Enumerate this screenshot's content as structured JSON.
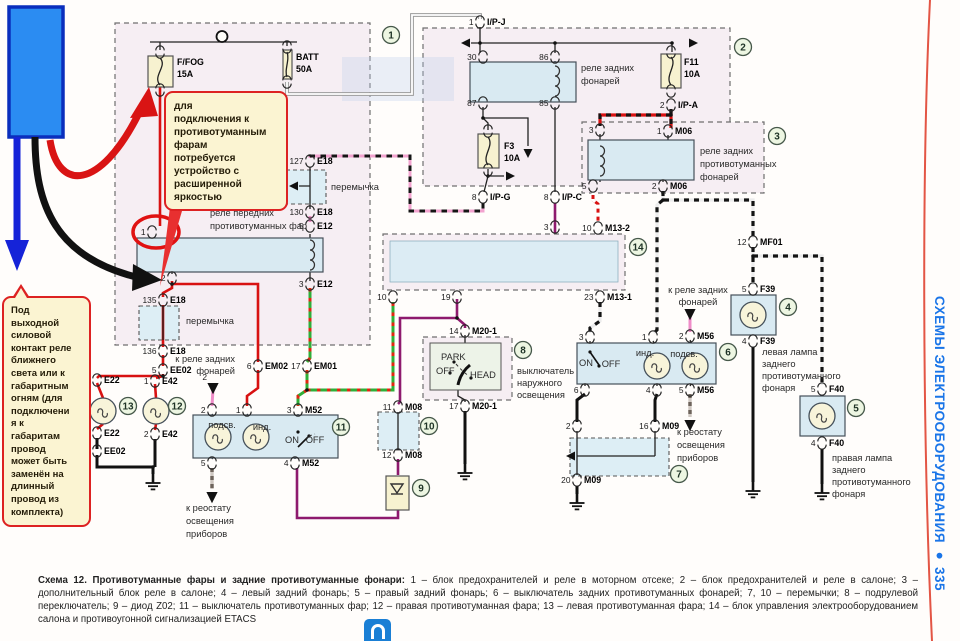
{
  "page": {
    "side_label": "СХЕМЫ ЭЛЕКТРООБОРУДОВАНИЯ ● 335",
    "caption_title": "Схема 12. Противотуманные фары и задние противотуманные фонари:",
    "caption_body": "1 – блок предохранителей и реле в моторном отсеке; 2 – блок предохранителей и реле в салоне; 3 – дополнительный блок реле в салоне; 4 – левый задний фонарь; 5 – правый задний фонарь; 6 – выключатель задних противотуманных фонарей; 7, 10 – перемычки; 8 – подрулевой переключатель; 9 – диод Z02; 11 – выключатель противотуманных фар; 12 – правая противотуманная фара; 13 – левая противотуманная фара; 14 – блок управления электрооборудованием салона и противоугонной сигнализацией ETACS",
    "colors": {
      "annotation_blue": "#2b8cf2",
      "annotation_red": "#d91414",
      "accent_blue_text": "#1a75e8",
      "callout_fill": "#fbf4d2"
    }
  },
  "callouts": {
    "top": "для\nподключения к\nпротивотуманным\nфарам\nпотребуется\nустройство с\nрасширенной\nяркостью",
    "left": "Под\nвыходной\nсиловой\nконтакт реле\nближнего\nсвета или к\nгабаритным\nогням (для\nподключени\nя к\nгабаритам\nпровод\nможет быть\nзаменён на\nдлинный\nпровод из\nкомплекта)"
  },
  "labels": {
    "ffog": "F/FOG",
    "ffog_a": "15A",
    "batt": "BATT",
    "batt_a": "50A",
    "f3": "F3",
    "f3_a": "10A",
    "f11": "F11",
    "f11_a": "10A",
    "relay_front_1": "реле передних",
    "relay_front_2": "противотуманных фар",
    "relay_rear_1": "реле задних",
    "relay_rear_2": "фонарей",
    "relay_rearfog_1": "реле задних",
    "relay_rearfog_2": "противотуманных",
    "relay_rearfog_3": "фонарей",
    "jumper": "перемычка",
    "ext_sw_1": "выключатель",
    "ext_sw_2": "наружного",
    "ext_sw_3": "освещения",
    "park": "PARK",
    "off": "OFF",
    "head": "HEAD",
    "on": "ON",
    "ind": "инд.",
    "podsv": "подсв.",
    "to_rear_1": "к реле задних",
    "to_rear_2": "фонарей",
    "rheo_1": "к реостату",
    "rheo_2": "освещения",
    "rheo_3": "приборов",
    "lamp_left_1": "левая лампа",
    "lamp_left_2": "заднего",
    "lamp_left_3": "противотуманного",
    "lamp_left_4": "фонаря",
    "lamp_right_1": "правая лампа",
    "lamp_right_2": "заднего",
    "lamp_right_3": "противотуманного",
    "lamp_right_4": "фонаря",
    "pin2": "2"
  },
  "schematic": {
    "connectors": [
      {
        "p": "1",
        "id": "I/P-J",
        "x": 480,
        "y": 22
      },
      {
        "p": "",
        "id": "",
        "x": 160,
        "y": 52
      },
      {
        "p": "",
        "id": "",
        "x": 160,
        "y": 90
      },
      {
        "p": "",
        "id": "",
        "x": 287,
        "y": 47
      },
      {
        "p": "",
        "id": "",
        "x": 287,
        "y": 82
      },
      {
        "p": "30",
        "id": "",
        "x": 483,
        "y": 57
      },
      {
        "p": "86",
        "id": "",
        "x": 555,
        "y": 57
      },
      {
        "p": "87",
        "id": "",
        "x": 483,
        "y": 103
      },
      {
        "p": "85",
        "id": "",
        "x": 555,
        "y": 103
      },
      {
        "p": "",
        "id": "",
        "x": 488,
        "y": 131
      },
      {
        "p": "",
        "id": "",
        "x": 488,
        "y": 170
      },
      {
        "p": "8",
        "id": "I/P-G",
        "x": 483,
        "y": 197
      },
      {
        "p": "8",
        "id": "I/P-C",
        "x": 555,
        "y": 197
      },
      {
        "p": "",
        "id": "",
        "x": 671,
        "y": 52
      },
      {
        "p": "",
        "id": "",
        "x": 671,
        "y": 91
      },
      {
        "p": "2",
        "id": "I/P-A",
        "x": 671,
        "y": 105
      },
      {
        "p": "1",
        "id": "M06",
        "x": 668,
        "y": 131
      },
      {
        "p": "3",
        "id": "",
        "x": 600,
        "y": 130
      },
      {
        "p": "5",
        "id": "",
        "x": 593,
        "y": 186
      },
      {
        "p": "2",
        "id": "M06",
        "x": 663,
        "y": 186
      },
      {
        "p": "127",
        "id": "E18",
        "x": 310,
        "y": 161
      },
      {
        "p": "130",
        "id": "E18",
        "x": 310,
        "y": 212
      },
      {
        "p": "5",
        "id": "E12",
        "x": 310,
        "y": 226
      },
      {
        "p": "3",
        "id": "E12",
        "x": 310,
        "y": 284
      },
      {
        "p": "1",
        "id": "",
        "x": 152,
        "y": 232
      },
      {
        "p": "2",
        "id": "",
        "x": 172,
        "y": 278
      },
      {
        "p": "135",
        "id": "E18",
        "x": 163,
        "y": 300
      },
      {
        "p": "136",
        "id": "E18",
        "x": 163,
        "y": 351
      },
      {
        "p": "5",
        "id": "EE02",
        "x": 163,
        "y": 370
      },
      {
        "p": "1",
        "id": "E22",
        "x": 97,
        "y": 380
      },
      {
        "p": "2",
        "id": "E22",
        "x": 97,
        "y": 433
      },
      {
        "p": "6",
        "id": "EE02",
        "x": 97,
        "y": 451
      },
      {
        "p": "1",
        "id": "E42",
        "x": 155,
        "y": 381
      },
      {
        "p": "2",
        "id": "E42",
        "x": 155,
        "y": 434
      },
      {
        "p": "6",
        "id": "EM02",
        "x": 258,
        "y": 366
      },
      {
        "p": "17",
        "id": "EM01",
        "x": 307,
        "y": 366
      },
      {
        "p": "3",
        "id": "",
        "x": 555,
        "y": 227
      },
      {
        "p": "10",
        "id": "M13-2",
        "x": 598,
        "y": 228
      },
      {
        "p": "10",
        "id": "",
        "x": 393,
        "y": 297
      },
      {
        "p": "19",
        "id": "",
        "x": 457,
        "y": 297
      },
      {
        "p": "23",
        "id": "M13-1",
        "x": 600,
        "y": 297
      },
      {
        "p": "12",
        "id": "MF01",
        "x": 753,
        "y": 242
      },
      {
        "p": "5",
        "id": "F39",
        "x": 753,
        "y": 289
      },
      {
        "p": "4",
        "id": "F39",
        "x": 753,
        "y": 341
      },
      {
        "p": "5",
        "id": "F40",
        "x": 822,
        "y": 389
      },
      {
        "p": "4",
        "id": "F40",
        "x": 822,
        "y": 443
      },
      {
        "p": "14",
        "id": "M20-1",
        "x": 465,
        "y": 331
      },
      {
        "p": "17",
        "id": "M20-1",
        "x": 465,
        "y": 406
      },
      {
        "p": "11",
        "id": "M08",
        "x": 398,
        "y": 407
      },
      {
        "p": "12",
        "id": "M08",
        "x": 398,
        "y": 455
      },
      {
        "p": "2",
        "id": "",
        "x": 212,
        "y": 410
      },
      {
        "p": "1",
        "id": "",
        "x": 247,
        "y": 410
      },
      {
        "p": "3",
        "id": "M52",
        "x": 298,
        "y": 410
      },
      {
        "p": "5",
        "id": "",
        "x": 212,
        "y": 463
      },
      {
        "p": "4",
        "id": "M52",
        "x": 295,
        "y": 463
      },
      {
        "p": "2",
        "id": "M56",
        "x": 690,
        "y": 336
      },
      {
        "p": "3",
        "id": "",
        "x": 590,
        "y": 337
      },
      {
        "p": "1",
        "id": "",
        "x": 653,
        "y": 337
      },
      {
        "p": "6",
        "id": "",
        "x": 585,
        "y": 390
      },
      {
        "p": "4",
        "id": "",
        "x": 657,
        "y": 390
      },
      {
        "p": "5",
        "id": "M56",
        "x": 690,
        "y": 390
      },
      {
        "p": "2",
        "id": "",
        "x": 577,
        "y": 426
      },
      {
        "p": "16",
        "id": "M09",
        "x": 655,
        "y": 426
      },
      {
        "p": "20",
        "id": "M09",
        "x": 577,
        "y": 480
      }
    ],
    "numbers": [
      {
        "n": "1",
        "x": 391,
        "y": 35
      },
      {
        "n": "2",
        "x": 743,
        "y": 47
      },
      {
        "n": "3",
        "x": 777,
        "y": 136
      },
      {
        "n": "4",
        "x": 788,
        "y": 307
      },
      {
        "n": "5",
        "x": 856,
        "y": 408
      },
      {
        "n": "6",
        "x": 728,
        "y": 352
      },
      {
        "n": "7",
        "x": 679,
        "y": 474
      },
      {
        "n": "8",
        "x": 523,
        "y": 350
      },
      {
        "n": "9",
        "x": 421,
        "y": 488
      },
      {
        "n": "10",
        "x": 429,
        "y": 426
      },
      {
        "n": "11",
        "x": 341,
        "y": 427
      },
      {
        "n": "12",
        "x": 177,
        "y": 406
      },
      {
        "n": "13",
        "x": 128,
        "y": 406
      },
      {
        "n": "14",
        "x": 638,
        "y": 247
      }
    ]
  }
}
